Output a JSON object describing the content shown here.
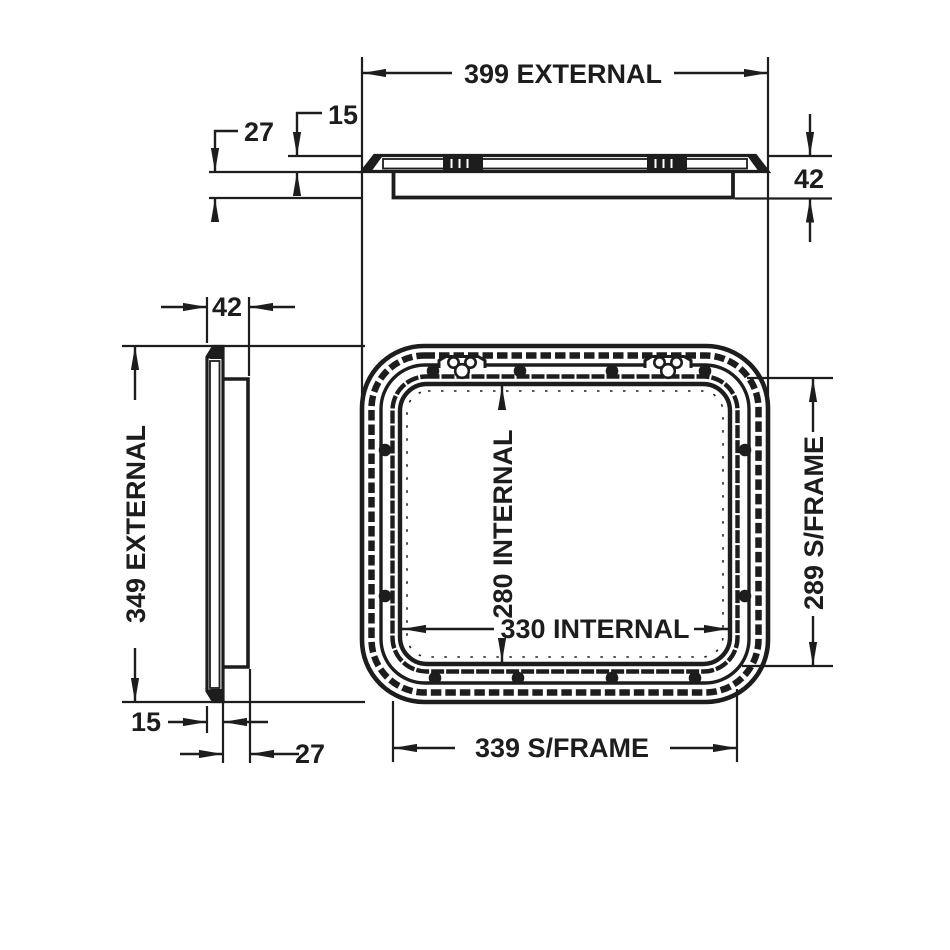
{
  "colors": {
    "ink": "#1d1d1d",
    "bg": "#ffffff"
  },
  "views": {
    "top_profile": {
      "external_width": "399 EXTERNAL",
      "flange_thickness": "15",
      "frame_depth": "27",
      "overall_depth": "42"
    },
    "side_profile": {
      "overall_depth": "42",
      "external_height": "349 EXTERNAL",
      "flange_thickness": "15",
      "frame_depth": "27"
    },
    "front": {
      "internal_height": "280 INTERNAL",
      "internal_width": "330 INTERNAL",
      "subframe_height": "289 S/FRAME",
      "subframe_width": "339 S/FRAME"
    }
  }
}
